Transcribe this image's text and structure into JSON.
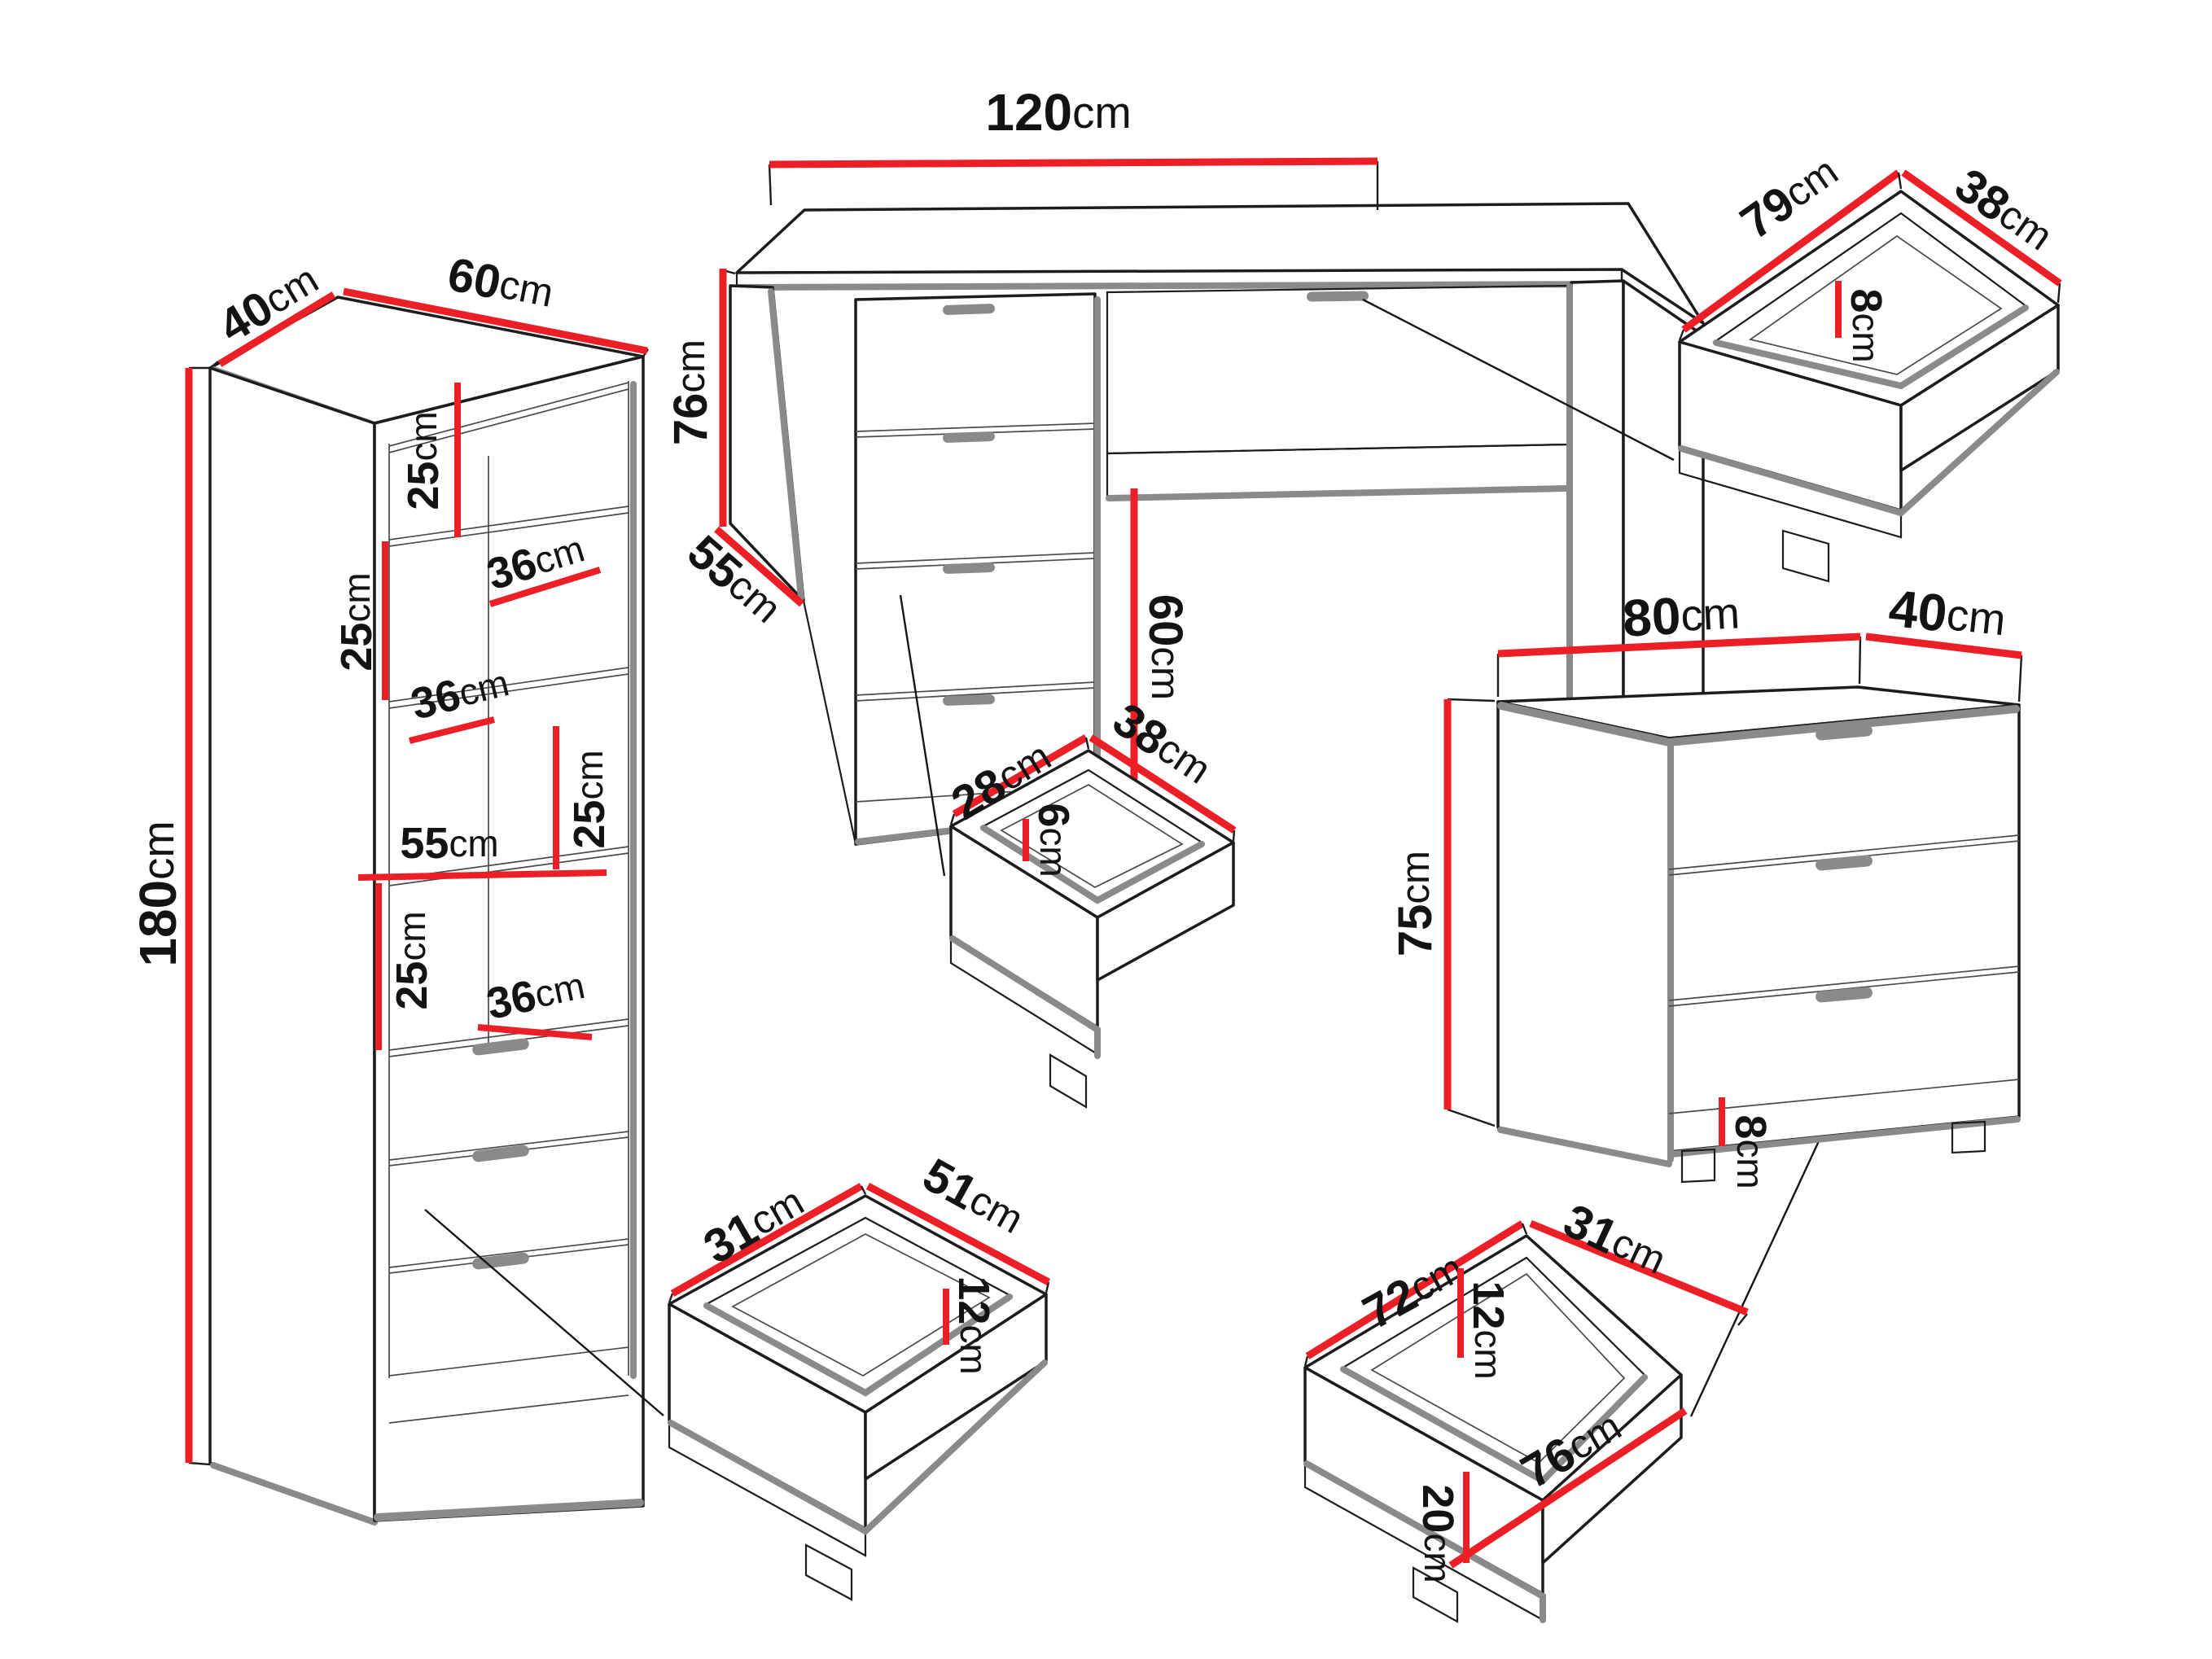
{
  "unit": "cm",
  "colors": {
    "dimension_line": "#ec1f26",
    "outline": "#1c1c1c",
    "shadow_edge": "#8a8a8a",
    "background": "#ffffff"
  },
  "furniture": {
    "wardrobe": {
      "depth": "40",
      "width": "60",
      "height": "180",
      "top_section": "25",
      "shelf1_depth": "36",
      "mid_section": "25",
      "shelf2_depth": "36",
      "lower_section": "25",
      "shelf_width": "55",
      "bottom_section": "25",
      "shelf3_depth": "36"
    },
    "desk": {
      "width": "120",
      "height": "76",
      "depth": "55",
      "knee_opening": "60"
    },
    "desk_drawer": {
      "width": "79",
      "depth": "38",
      "inner_height": "8"
    },
    "small_drawer": {
      "width": "28",
      "depth": "38",
      "inner_height": "6"
    },
    "chest": {
      "width": "80",
      "depth": "40",
      "height": "75",
      "plinth_height": "8"
    },
    "cabinet_drawer": {
      "depth": "31",
      "width": "51",
      "inner_height": "12"
    },
    "chest_drawer": {
      "width": "72",
      "depth": "31",
      "inner_height": "12",
      "front_height": "20",
      "front_width": "76"
    }
  }
}
